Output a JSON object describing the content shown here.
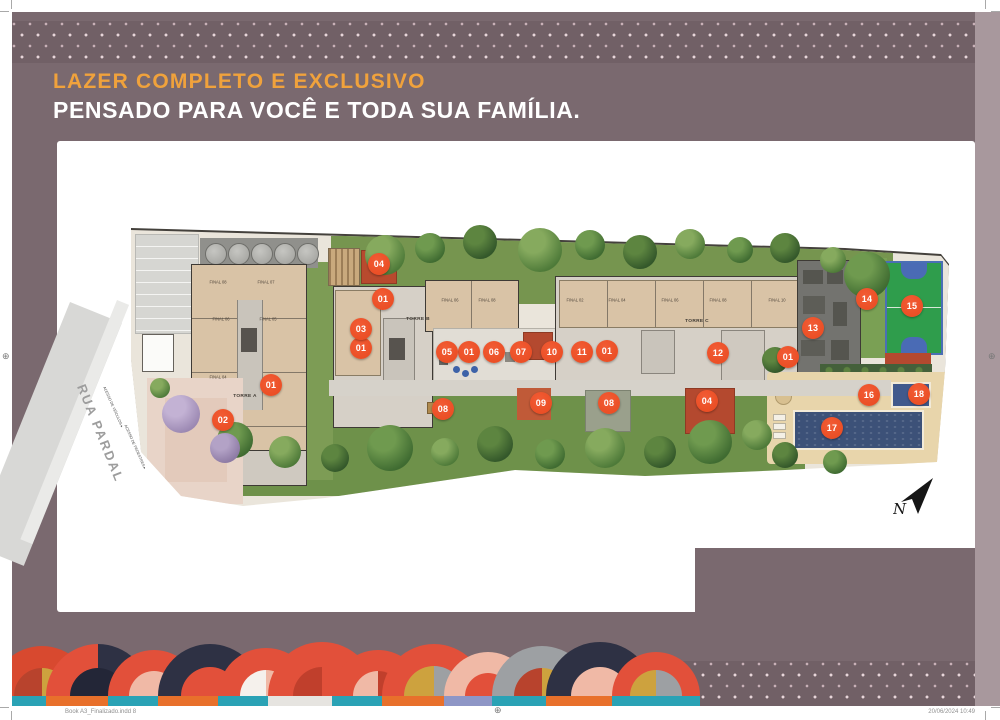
{
  "header": {
    "title_line1": "LAZER COMPLETO E EXCLUSIVO",
    "title_line2": "PENSADO PARA VOCÊ E TODA SUA FAMÍLIA."
  },
  "footer": {
    "left_text": "Book A3_Finalizado.indd   8",
    "right_text": "20/06/2024   10:49"
  },
  "colors": {
    "page_background": "#7a696f",
    "accent_orange": "#f0a23c",
    "marker_red": "#e8491f",
    "card_white": "#ffffff",
    "teal": "#2aa2b5",
    "navy": "#2e3144",
    "gold": "#cda23e",
    "salmon": "#f0b9a6",
    "orange": "#e8702b"
  },
  "plan": {
    "street_label": "RUA PARDAL",
    "north_label": "N",
    "access_labels": [
      {
        "t": "ACESSO DE VEÍCULOS",
        "x": 28,
        "y": 207
      },
      {
        "t": "ACESSO DE PEDESTRES",
        "x": 50,
        "y": 247
      }
    ],
    "tower_labels": [
      {
        "t": "TORRE A",
        "x": 160,
        "y": 196
      },
      {
        "t": "TORRE B",
        "x": 333,
        "y": 119
      },
      {
        "t": "TORRE C",
        "x": 612,
        "y": 121
      }
    ],
    "unit_labels": [
      {
        "t": "FINAL 08",
        "x": 133,
        "y": 83
      },
      {
        "t": "FINAL 07",
        "x": 181,
        "y": 83
      },
      {
        "t": "FINAL 06",
        "x": 136,
        "y": 120
      },
      {
        "t": "FINAL 05",
        "x": 183,
        "y": 120
      },
      {
        "t": "FINAL 04",
        "x": 133,
        "y": 178
      },
      {
        "t": "FINAL 06",
        "x": 365,
        "y": 101
      },
      {
        "t": "FINAL 08",
        "x": 402,
        "y": 101
      },
      {
        "t": "FINAL 02",
        "x": 490,
        "y": 101
      },
      {
        "t": "FINAL 04",
        "x": 532,
        "y": 101
      },
      {
        "t": "FINAL 06",
        "x": 585,
        "y": 101
      },
      {
        "t": "FINAL 08",
        "x": 633,
        "y": 101
      },
      {
        "t": "FINAL 10",
        "x": 692,
        "y": 101
      }
    ],
    "markers": [
      {
        "n": "01",
        "x": 298,
        "y": 99
      },
      {
        "n": "01",
        "x": 276,
        "y": 148
      },
      {
        "n": "01",
        "x": 186,
        "y": 185
      },
      {
        "n": "01",
        "x": 384,
        "y": 152
      },
      {
        "n": "01",
        "x": 522,
        "y": 151
      },
      {
        "n": "01",
        "x": 703,
        "y": 157
      },
      {
        "n": "02",
        "x": 138,
        "y": 220
      },
      {
        "n": "03",
        "x": 276,
        "y": 129
      },
      {
        "n": "04",
        "x": 294,
        "y": 64
      },
      {
        "n": "04",
        "x": 622,
        "y": 201
      },
      {
        "n": "05",
        "x": 362,
        "y": 152
      },
      {
        "n": "06",
        "x": 409,
        "y": 152
      },
      {
        "n": "07",
        "x": 436,
        "y": 152
      },
      {
        "n": "08",
        "x": 358,
        "y": 209
      },
      {
        "n": "08",
        "x": 524,
        "y": 203
      },
      {
        "n": "09",
        "x": 456,
        "y": 203
      },
      {
        "n": "10",
        "x": 467,
        "y": 152
      },
      {
        "n": "11",
        "x": 497,
        "y": 152
      },
      {
        "n": "12",
        "x": 633,
        "y": 153
      },
      {
        "n": "13",
        "x": 728,
        "y": 128
      },
      {
        "n": "14",
        "x": 782,
        "y": 99
      },
      {
        "n": "15",
        "x": 827,
        "y": 106
      },
      {
        "n": "16",
        "x": 784,
        "y": 195
      },
      {
        "n": "17",
        "x": 747,
        "y": 228
      },
      {
        "n": "18",
        "x": 834,
        "y": 194
      }
    ]
  },
  "decor": {
    "fans": [
      {
        "x": 30,
        "r": 50,
        "outer": "#d8492f",
        "i1": "#b8432d",
        "i2": "#cda23e",
        "ri": 28,
        "base": "#2aa2b5"
      },
      {
        "x": 86,
        "r": 52,
        "outer": "#e2503a",
        "o2": "#2e3144",
        "i1": "#232637",
        "i2": "#232637",
        "ri": 28,
        "base": "#e8702b"
      },
      {
        "x": 142,
        "r": 46,
        "outer": "#e2503a",
        "i1": "#f0b9a6",
        "i2": "#f0b9a6",
        "ri": 25,
        "base": "#2aa2b5"
      },
      {
        "x": 198,
        "r": 52,
        "outer": "#2e3144",
        "i1": "#e2503a",
        "i2": "#e2503a",
        "ri": 29,
        "base": "#e8702b"
      },
      {
        "x": 254,
        "r": 48,
        "outer": "#e2503a",
        "i1": "#f5f1ec",
        "i2": "#f0b9a6",
        "ri": 26,
        "base": "#2aa2b5"
      },
      {
        "x": 310,
        "r": 54,
        "outer": "#e2503a",
        "i1": "#c03f2c",
        "i2": "#e2503a",
        "ri": 29,
        "base": "#e6e4e0"
      },
      {
        "x": 366,
        "r": 46,
        "outer": "#e2503a",
        "i1": "#f0b9a6",
        "i2": "#c03f2c",
        "ri": 25,
        "base": "#2aa2b5"
      },
      {
        "x": 422,
        "r": 52,
        "outer": "#e2503a",
        "i1": "#cda23e",
        "i2": "#9da0a3",
        "ri": 30,
        "base": "#e8702b"
      },
      {
        "x": 476,
        "r": 44,
        "outer": "#f0b9a6",
        "i1": "#e2503a",
        "i2": "#e2503a",
        "ri": 23,
        "base": "#8e96c6"
      },
      {
        "x": 530,
        "r": 50,
        "outer": "#9da0a3",
        "i1": "#b8432d",
        "i2": "#cda23e",
        "ri": 28,
        "base": "#2aa2b5"
      },
      {
        "x": 588,
        "r": 54,
        "outer": "#2e3144",
        "i1": "#f0b9a6",
        "i2": "#f0b9a6",
        "ri": 29,
        "base": "#e8702b"
      },
      {
        "x": 644,
        "r": 44,
        "outer": "#e2503a",
        "i1": "#cda23e",
        "i2": "#9da0a3",
        "ri": 26,
        "base": "#2aa2b5"
      }
    ]
  }
}
